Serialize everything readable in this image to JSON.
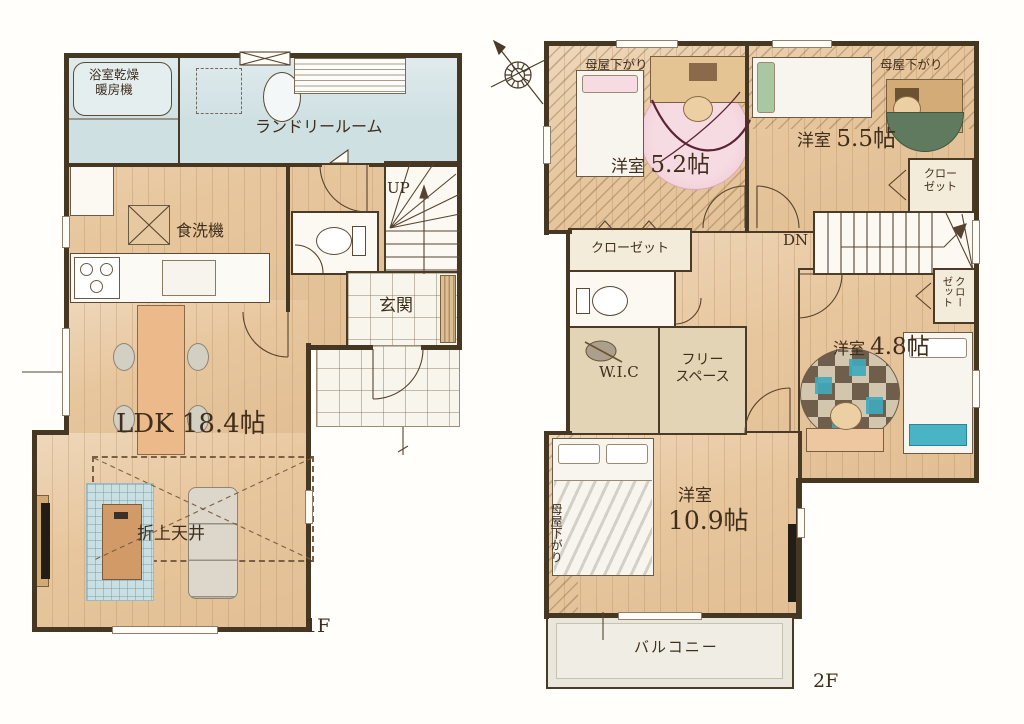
{
  "document": {
    "type": "floor-plan",
    "floors": 2
  },
  "colors": {
    "wall": "#463723",
    "wood_floor": "#e7c69d",
    "wet_area": "#cfe0e3",
    "tile": "#f8f5ec",
    "closet_fill": "#f4ecdb",
    "storage_floor": "#e2d4b4",
    "balcony": "#e9e6dc",
    "text": "#3f2e1c",
    "accent_pink": "#f2cdd8",
    "accent_green": "#5f7a5e",
    "accent_teal": "#3fa9bc"
  },
  "floor1": {
    "floor_label": "1F",
    "bath_heater_label": "浴室乾燥暖房機",
    "laundry_label": "ランドリールーム",
    "dishwasher_label": "食洗機",
    "stairs_label": "UP",
    "entrance_label": "玄関",
    "ldk_label": "LDK 18.4帖",
    "ceiling_label": "折上天井"
  },
  "floor2": {
    "floor_label": "2F",
    "room52_name": "洋室",
    "room52_size": "5.2帖",
    "room52_note": "母屋下がり",
    "room55_name": "洋室",
    "room55_size": "5.5帖",
    "room55_note": "母屋下がり",
    "closet55_label": "クローゼット",
    "closet52_label": "クローゼット",
    "closet48_label": "クローゼット",
    "stairs_label": "DN",
    "wic_label": "W.I.C",
    "free_space_line1": "フリー",
    "free_space_line2": "スペース",
    "room48_name": "洋室",
    "room48_size": "4.8帖",
    "room109_name": "洋室",
    "room109_size": "10.9帖",
    "room109_note": "母屋下がり",
    "balcony_label": "バルコニー"
  }
}
